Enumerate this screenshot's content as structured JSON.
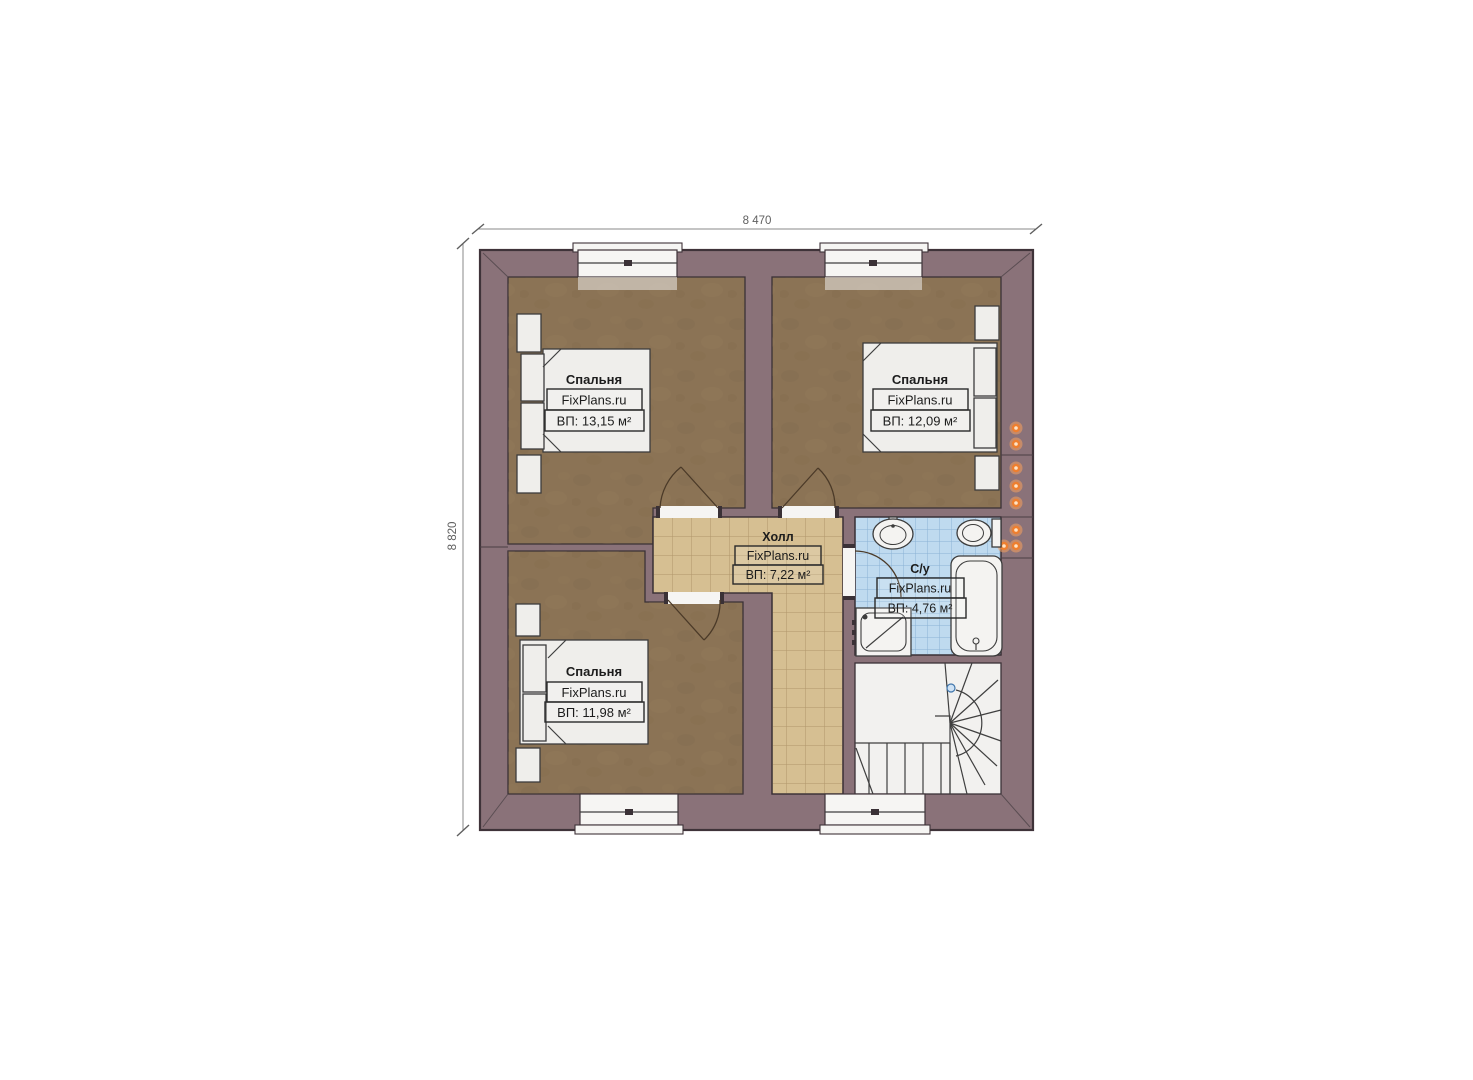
{
  "page": {
    "background": "#ffffff"
  },
  "plan": {
    "dimension_top": "8 470",
    "dimension_left": "8 820",
    "rooms": [
      {
        "id": "bedroom-top-left",
        "name": "Спальня",
        "brand": "FixPlans.ru",
        "area": "ВП: 13,15 м²"
      },
      {
        "id": "bedroom-top-right",
        "name": "Спальня",
        "brand": "FixPlans.ru",
        "area": "ВП: 12,09 м²"
      },
      {
        "id": "bedroom-bottom-left",
        "name": "Спальня",
        "brand": "FixPlans.ru",
        "area": "ВП: 11,98 м²"
      },
      {
        "id": "hall",
        "name": "Холл",
        "brand": "FixPlans.ru",
        "area": "ВП: 7,22 м²"
      },
      {
        "id": "bathroom",
        "name": "С/у",
        "brand": "FixPlans.ru",
        "area": "ВП: 4,76 м²"
      }
    ],
    "colors": {
      "wall": "#8a7279",
      "wall_outline": "#3f3339",
      "bedroom_floor": "#8b7355",
      "hall_floor": "#d6bf92",
      "hall_grid": "#a98f63",
      "bath_floor": "#bfdaef",
      "bath_grid": "#85aed2",
      "stairs_floor": "#f2f1ef",
      "furniture": "#efeeeb",
      "window": "#f6f5f3",
      "vent": "#ee7f2f",
      "dimension": "#6f6f6f"
    }
  }
}
